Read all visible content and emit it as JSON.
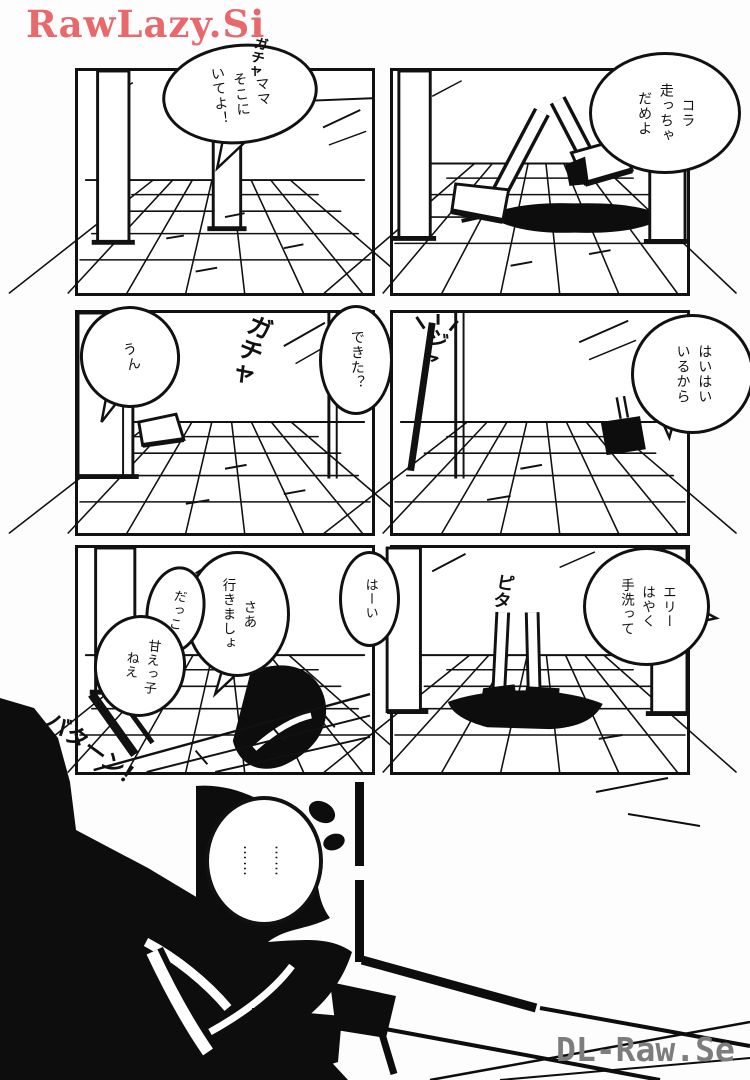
{
  "watermarks": {
    "top_left": "RawLazy.Si",
    "bottom_right": "DL-Raw.Se"
  },
  "colors": {
    "watermark_red": "#e8696b",
    "watermark_gray": "#7d7d7d",
    "ink": "#111111",
    "paper": "#ffffff"
  },
  "panels": [
    {
      "name": "panel-1",
      "bubbles": [
        {
          "text": "ママ\nそこに\nいてよ！"
        }
      ],
      "sfx": [
        {
          "text": "ガチャ"
        }
      ]
    },
    {
      "name": "panel-2",
      "bubbles": [
        {
          "text": "コラ\n走っちゃ\nだめよ"
        }
      ],
      "sfx": []
    },
    {
      "name": "panel-3",
      "bubbles": [
        {
          "text": "うん"
        },
        {
          "text": "できた？"
        }
      ],
      "sfx": [
        {
          "text": "ガチャ"
        }
      ]
    },
    {
      "name": "panel-4",
      "bubbles": [
        {
          "text": "はいはい\nいるから"
        }
      ],
      "sfx": [
        {
          "text": "ジャ"
        }
      ]
    },
    {
      "name": "panel-5",
      "bubbles": [
        {
          "text": "さあ\n行きましょ"
        },
        {
          "text": "はーい"
        },
        {
          "text": "だっこ"
        },
        {
          "text": "甘えっ子\nねえ"
        }
      ],
      "sfx": [
        {
          "text": "バターン！"
        }
      ]
    },
    {
      "name": "panel-6",
      "bubbles": [
        {
          "text": "エリー\nはやく\n手洗って"
        }
      ],
      "sfx": [
        {
          "text": "ピタ"
        }
      ]
    },
    {
      "name": "panel-bottom",
      "bubbles": [
        {
          "text": "……\n……"
        }
      ],
      "sfx": []
    }
  ]
}
